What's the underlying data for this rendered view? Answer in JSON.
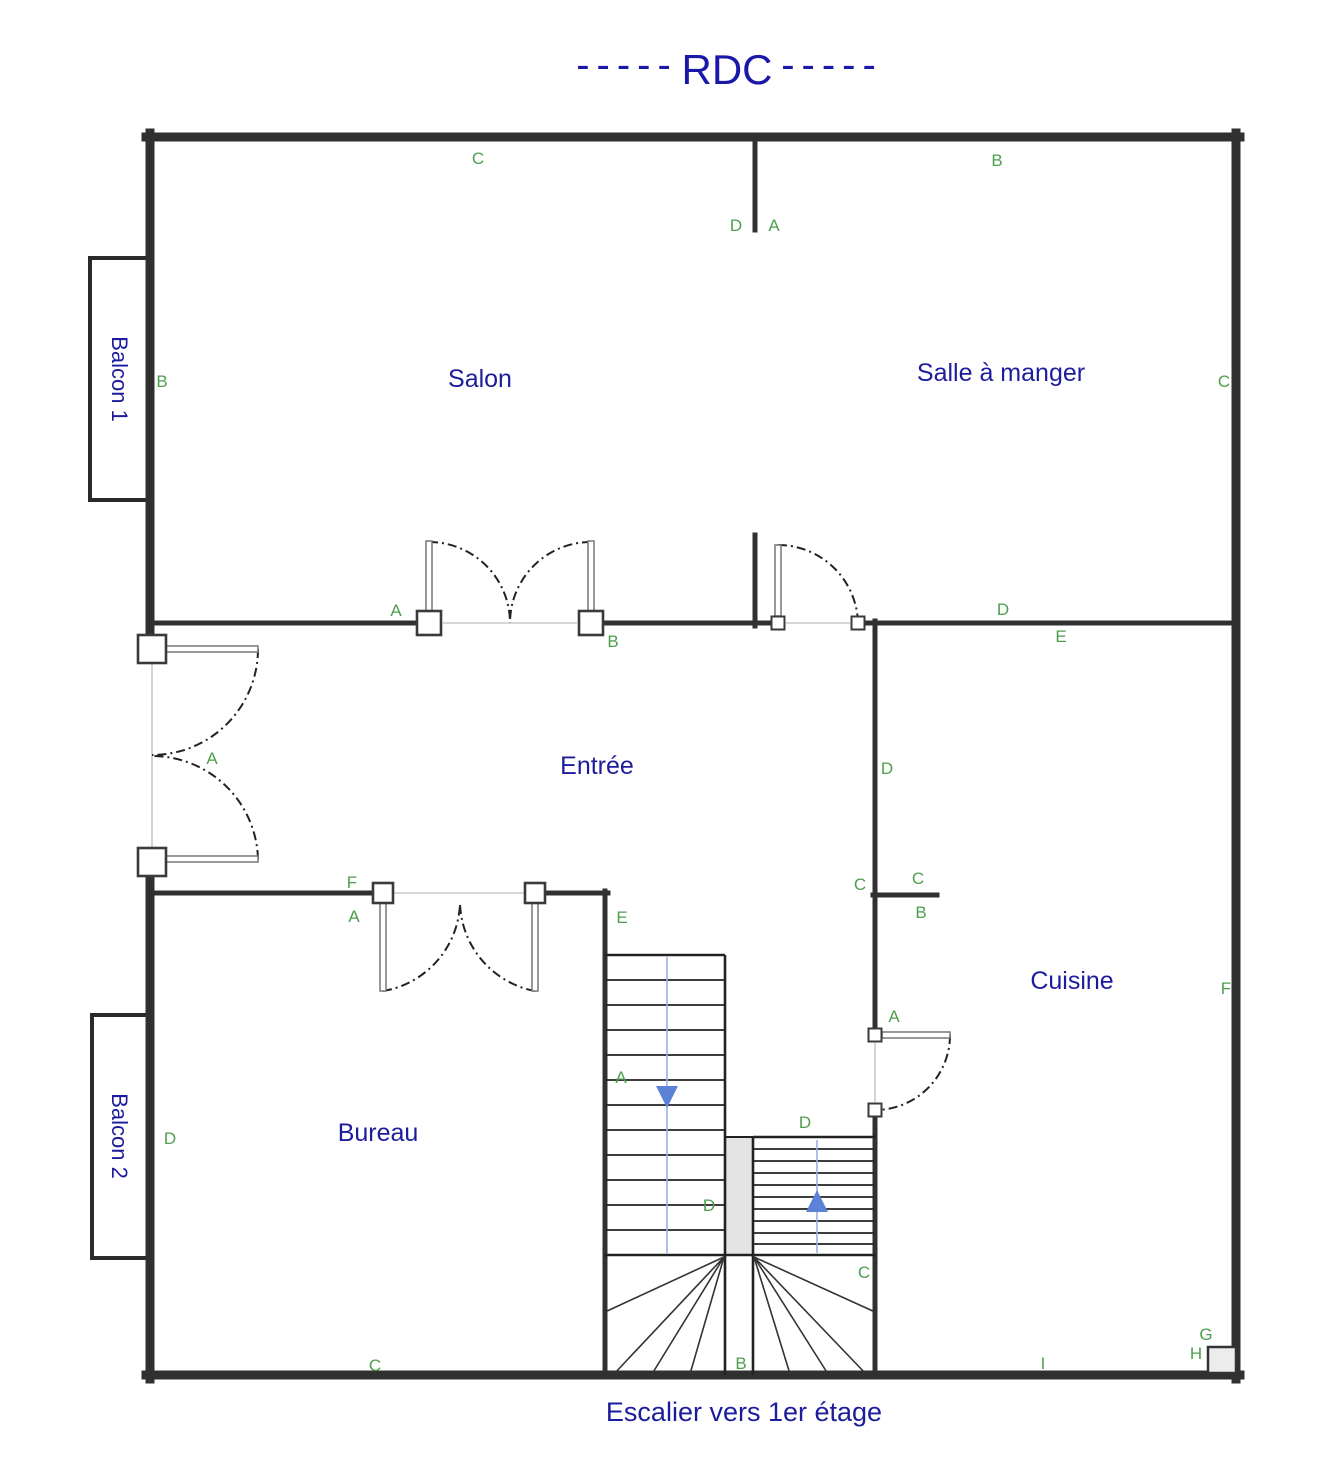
{
  "title": {
    "text": "RDC",
    "dashes_left": "-----",
    "dashes_right": "-----"
  },
  "rooms": {
    "salon": "Salon",
    "salle_a_manger": "Salle à manger",
    "entree": "Entrée",
    "cuisine": "Cuisine",
    "bureau": "Bureau",
    "balcon1": "Balcon 1",
    "balcon2": "Balcon 2"
  },
  "stairs_caption": "Escalier vers 1er étage",
  "wall_markers": {
    "salon_top": "C",
    "dining_top": "B",
    "opening_top_left": "D",
    "opening_top_right": "A",
    "salon_west": "B",
    "dining_east": "C",
    "salon_door_left": "A",
    "salon_door_right": "B",
    "dining_wall_left": "D",
    "dining_wall_right": "E",
    "entrance_french_door": "A",
    "kitchen_wall_upper": "D",
    "kitchen_stub_west": "C",
    "kitchen_stub_top": "C",
    "kitchen_stub_bottom": "B",
    "bureau_door_f": "F",
    "bureau_door_a": "A",
    "bureau_wall_e": "E",
    "kitchen_door": "A",
    "stair_left_a": "A",
    "stair_divider_d": "D",
    "stair_right_top_d": "D",
    "stair_fan_c": "C",
    "stair_fan_b": "B",
    "bureau_west_d": "D",
    "bureau_bottom_c": "C",
    "kitchen_bottom_i": "I",
    "chimney_g": "G",
    "chimney_h": "H",
    "kitchen_east_f": "F"
  },
  "colors": {
    "room_label": "#1c1c9c",
    "marker_green": "#4d9e4d",
    "title_blue": "#1a18a8",
    "wall": "#303030",
    "stair_arrow_blue": "#5b82d6",
    "stair_line_blue": "#9ab0e4",
    "divider_gray": "#e4e4e4"
  }
}
